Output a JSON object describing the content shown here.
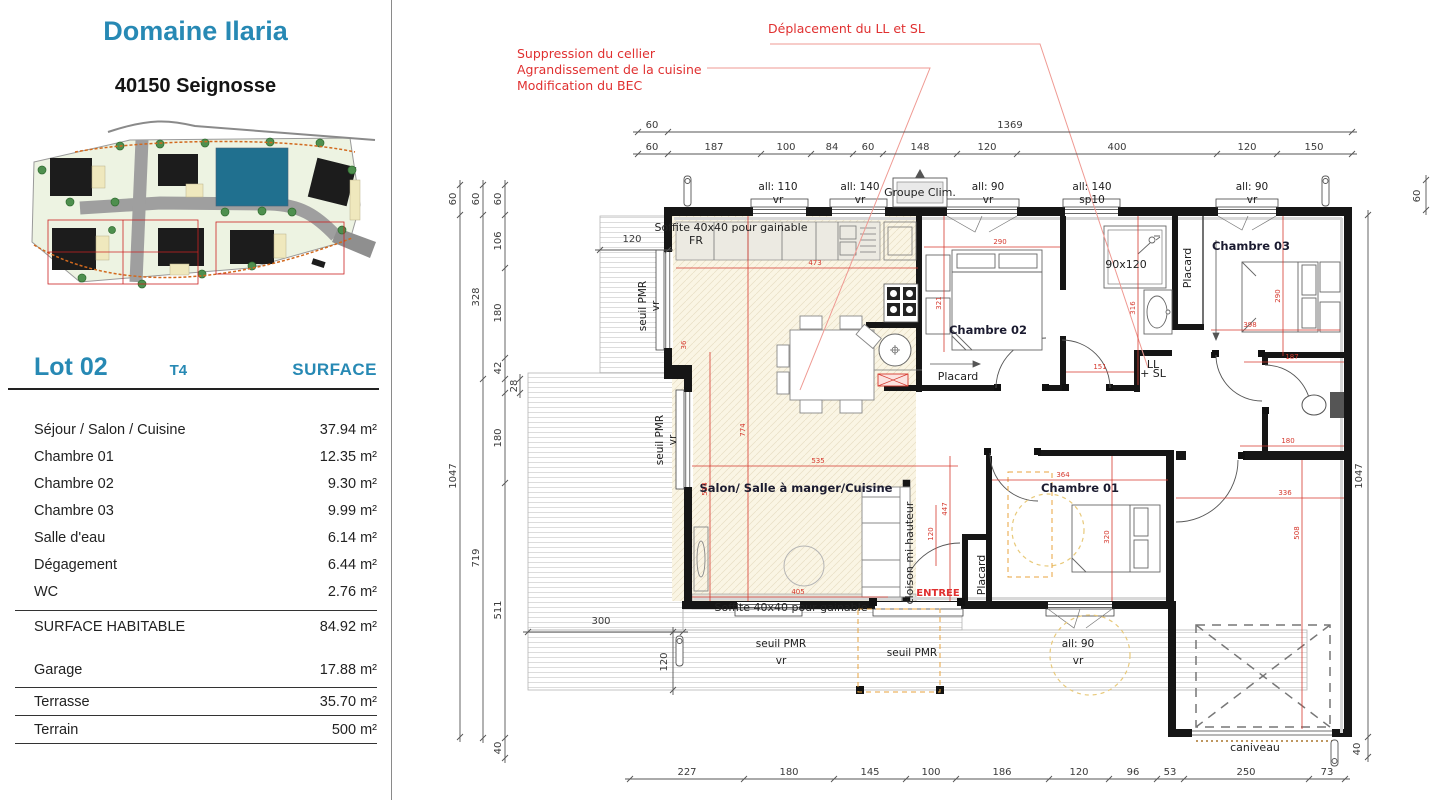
{
  "panel": {
    "title": "Domaine Ilaria",
    "subtitle": "40150 Seignosse",
    "lot": "Lot 02",
    "type": "T4",
    "surface_col": "SURFACE",
    "rows": [
      {
        "label": "Séjour / Salon / Cuisine",
        "value": "37.94 m²"
      },
      {
        "label": "Chambre 01",
        "value": "12.35 m²"
      },
      {
        "label": "Chambre 02",
        "value": "9.30 m²"
      },
      {
        "label": "Chambre 03",
        "value": "9.99 m²"
      },
      {
        "label": "Salle d'eau",
        "value": "6.14 m²"
      },
      {
        "label": "Dégagement",
        "value": "6.44 m²"
      },
      {
        "label": "WC",
        "value": "2.76 m²"
      }
    ],
    "total": {
      "label": "SURFACE HABITABLE",
      "value": "84.92 m²"
    },
    "annex": [
      {
        "label": "Garage",
        "value": "17.88 m²"
      },
      {
        "label": "Terrasse",
        "value": "35.70 m²"
      },
      {
        "label": "Terrain",
        "value": "500 m²"
      }
    ]
  },
  "annotations": {
    "left": [
      "Suppression du cellier",
      "Agrandissement de la cuisine",
      "Modification du BEC"
    ],
    "right": "Déplacement du LL et SL"
  },
  "plan": {
    "rooms": {
      "salon": "Salon/ Salle à manger/Cuisine",
      "ch01": "Chambre 01",
      "ch02": "Chambre 02",
      "ch03": "Chambre 03",
      "placard": "Placard",
      "fr": "FR",
      "soffite": "Soffite 40x40 pour gainable",
      "groupe_clim": "Groupe Clim.",
      "shower": "90x120",
      "ll": "LL",
      "sl": "+ SL",
      "cloison": "cloison mi-hauteur",
      "entree": "ENTREE",
      "caniveau": "caniveau",
      "seuil": "seuil PMR",
      "vr": "vr",
      "sp10": "sp10",
      "all110": "all: 110",
      "all140": "all: 140",
      "all90": "all: 90"
    },
    "dims": {
      "top1": [
        "60",
        "1369"
      ],
      "top2": [
        "60",
        "187",
        "100",
        "84",
        "60",
        "148",
        "120",
        "400",
        "120",
        "150"
      ],
      "bottom": [
        "227",
        "180",
        "145",
        "100",
        "186",
        "120",
        "96",
        "53",
        "250",
        "73"
      ],
      "left1": [
        "60",
        "1047"
      ],
      "left2": [
        "60",
        "328",
        "719"
      ],
      "left3": [
        "60",
        "106",
        "180",
        "42",
        "28",
        "180",
        "511",
        "40"
      ],
      "right": [
        "60",
        "1047",
        "40"
      ],
      "inner": [
        "120",
        "300",
        "120"
      ]
    },
    "red_dims": [
      "473",
      "290",
      "321",
      "316",
      "290",
      "398",
      "187",
      "151",
      "535",
      "774",
      "514",
      "405",
      "120",
      "447",
      "36",
      "364",
      "320",
      "336",
      "508",
      "180"
    ]
  },
  "colors": {
    "accent": "#2789b4",
    "red_annotation": "#e03030",
    "red_dim": "#d63a2f",
    "lot_fill": "#20708f"
  }
}
